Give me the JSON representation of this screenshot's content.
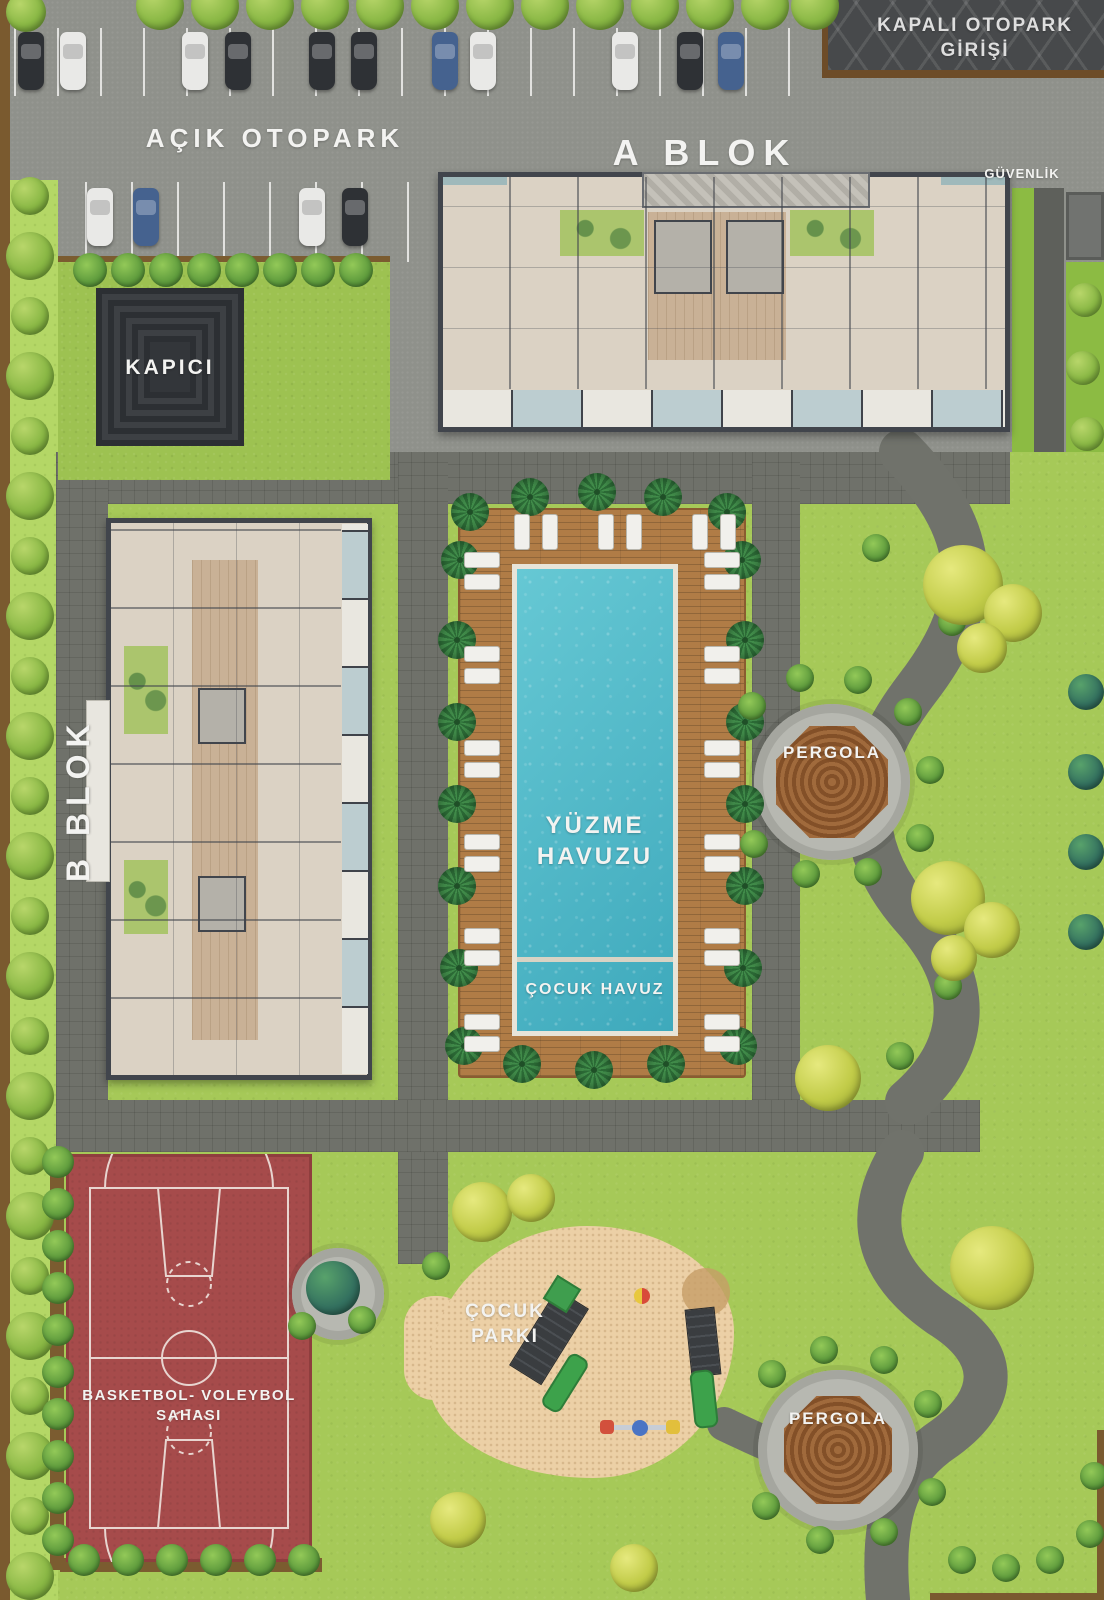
{
  "site_plan": {
    "covered_parking_sign": {
      "line1": "KAPALI OTOPARK",
      "line2": "GİRİŞİ"
    },
    "open_parking_label": "AÇIK OTOPARK",
    "block_a_label": "A BLOK",
    "security_label": "GÜVENLİK",
    "caretaker_label": "KAPICI",
    "block_b_label": "B BLOK",
    "pool": {
      "line1": "YÜZME",
      "line2": "HAVUZU",
      "kids_pool_label": "ÇOCUK HAVUZ"
    },
    "pergola_top_label": "PERGOLA",
    "pergola_bottom_label": "PERGOLA",
    "sports_court": {
      "line1": "BASKETBOL- VOLEYBOL",
      "line2": "SAHASI"
    },
    "kids_park": {
      "line1": "ÇOCUK",
      "line2": "PARKI"
    },
    "colors": {
      "grass": "#a6c958",
      "road_pavers": "#6f716a",
      "asphalt": "#8f918b",
      "pool_water": "#4db8c8",
      "pool_deck_wood": "#b07c46",
      "court_surface": "#a64b4b",
      "sand": "#ecd0a6",
      "pergola_wood": "#96613a",
      "ramp": "#47494b",
      "label_text": "#f3f3f1"
    }
  }
}
